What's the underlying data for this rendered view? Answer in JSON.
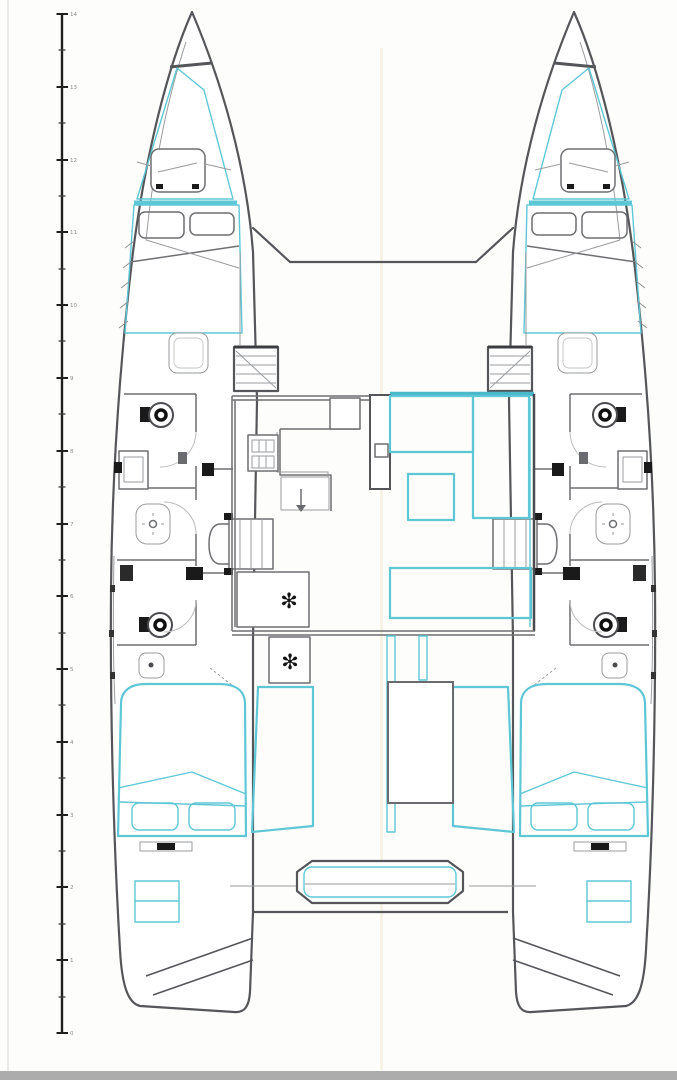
{
  "ruler": {
    "labels": [
      "14",
      "13",
      "12",
      "11",
      "10",
      "9",
      "8",
      "7",
      "6",
      "5",
      "4",
      "3",
      "2",
      "1",
      "0"
    ]
  },
  "symbols": {
    "snowflake": "✻"
  },
  "colors": {
    "accent_cyan": "#5ec7d6",
    "accent_cyan_bold": "#49b8cb",
    "line_dark": "#55565a",
    "line_mid": "#6e6f72",
    "line_light": "#9a9b9e",
    "symbol_black": "#141414",
    "bottom_bar": "#acacac",
    "background": "#fdfdfc"
  }
}
